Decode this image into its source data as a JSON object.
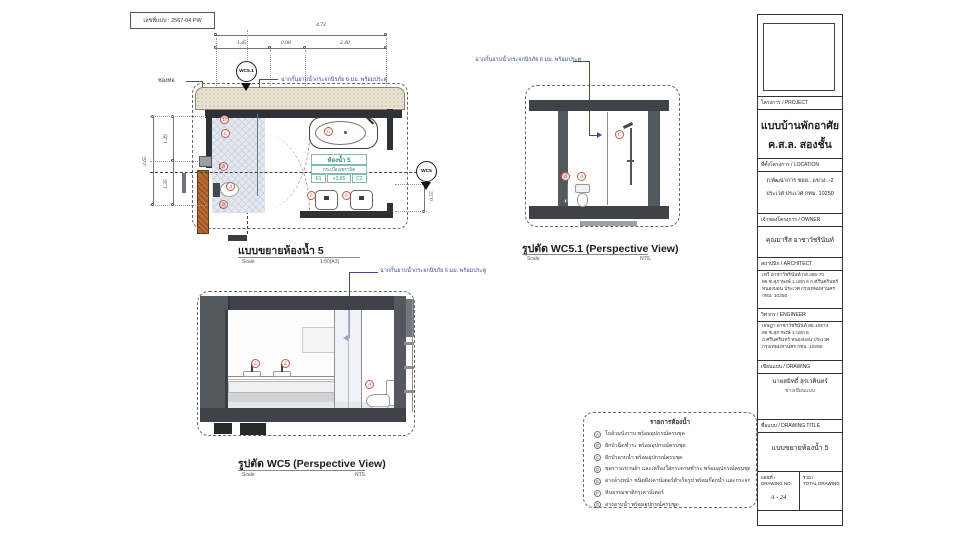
{
  "doc": {
    "number_label": "เลขที่แบบ : 2567-04 PW"
  },
  "plan": {
    "title": "แบบขยายห้องน้ำ 5",
    "scale_label": "Scale",
    "scale_value": "1:50(A3)",
    "dim_total_w": "4.73",
    "dim_w1": "1.45",
    "dim_w2": "0.90",
    "dim_w3": "2.40",
    "dim_h_total": "2.65",
    "dim_h1": "1.29",
    "dim_h2": "1.35",
    "dim_right": "0.55",
    "pipe_shaft_label": "ช่องท่อ",
    "glass_note": "ฉากกั้นอาบน้ำกระจกนิรภัย 6 มม. พร้อมประตู",
    "section_marker_top": "WC5.1",
    "section_marker_right": "WC5",
    "room": {
      "name": "ห้องน้ำ 5",
      "material": "กระเบื้องเซรามิค",
      "floor_code": "F1",
      "level": "+3.65",
      "ceiling_code": "C2"
    },
    "markers": [
      "D",
      "C",
      "B",
      "A",
      "B",
      "G",
      "F",
      "F"
    ]
  },
  "view_wc51": {
    "title": "รูปตัด WC5.1 (Perspective View)",
    "scale_label": "Scale",
    "scale_value": "NTS.",
    "glass_note": "ฉากกั้นอาบน้ำกระจกนิรภัย 6 มม. พร้อมประตู",
    "markers": [
      "B",
      "A",
      "C"
    ]
  },
  "view_wc5": {
    "title": "รูปตัด WC5 (Perspective View)",
    "scale_label": "Scale",
    "scale_value": "NTS.",
    "glass_note": "ฉากกั้นอาบน้ำกระจกนิรภัย 6 มม. พร้อมประตู",
    "markers": [
      "E",
      "E",
      "A"
    ]
  },
  "legend": {
    "title": "รายการห้องน้ำ",
    "items": [
      {
        "key": "A",
        "text": "โถส้วมนั่งราบ พร้อมอุปกรณ์ครบชุด"
      },
      {
        "key": "B",
        "text": "ฝักบัวฉีดชำระ พร้อมอุปกรณ์ครบชุด"
      },
      {
        "key": "C",
        "text": "ฝักบัวอาบน้ำ พร้อมอุปกรณ์ครบชุด"
      },
      {
        "key": "D",
        "text": "ชุดราวแขวนผ้า และเครื่องใส่กระดาษชำระ พร้อมอุปกรณ์ครบชุด"
      },
      {
        "key": "E",
        "text": "อ่างล้างหน้า ชนิดฝังเคาน์เตอร์สำเร็จรูป พร้อมก๊อกน้ำ และกระจกเงา"
      },
      {
        "key": "F",
        "text": "หินธรรมชาติกรุเคาน์เตอร์"
      },
      {
        "key": "G",
        "text": "อ่างอาบน้ำ พร้อมอุปกรณ์ครบชุด"
      }
    ]
  },
  "titleblock": {
    "project_label": "โครงการ / PROJECT",
    "project_name_1": "แบบบ้านพักอาศัย",
    "project_name_2": "ค.ส.ล. สองชั้น",
    "location_label": "ที่ตั้งโครงการ / LOCATION",
    "location_lines": [
      "ถ.พัฒนาการ ซอย.. แขวง..-2",
      "ประเวศ ประเวศ กทม. 10250"
    ],
    "owner_label": "เจ้าของโครงการ / OWNER",
    "owner_name": "คุณมารีส อาชาวัชรินันท์",
    "architect_label": "สถาปนิก / ARCHITECT",
    "architect_lines": [
      "เทวี อาชาวัชรินันท์ กส.285-70",
      "88 ซ.สุภาพงษ์ 1 แยก 6 ถ.ศรีนครินทร์",
      "หนองบอน ประเวศ กรุงเทพมหานคร",
      "กทม. 10250"
    ],
    "engineer_label": "วิศวกร / ENGINEER",
    "engineer_lines": [
      "เจษฎา อาชาวัชรินันท์ สย.10574",
      "88 ซ.สุภาพงษ์ 1 แยก 6",
      "ถ.ศรีนครินทร์ หนองบอน ประเวศ",
      "กรุงเทพมหานคร กทม. 10250"
    ],
    "drawing_label": "เขียนแบบ / DRAWING",
    "drawer_name": "นายสมิทธิ์ สุรเวคินทร์",
    "drawer_role": "ช่างเขียนแบบ",
    "title_label": "ชื่อแบบ / DRAWING TITLE",
    "drawing_title": "แบบขยายห้องน้ำ 5",
    "sheet_no_label_1": "แผ่นที่ /",
    "sheet_no_label_2": "DRAWING NO.",
    "sheet_no": "A - 24",
    "total_label_1": "รวม /",
    "total_label_2": "TOTAL DRAWING"
  },
  "colors": {
    "annotation_blue": "#3c4aa0",
    "label_teal": "#2e8b80",
    "marker_red": "#c0564a"
  }
}
